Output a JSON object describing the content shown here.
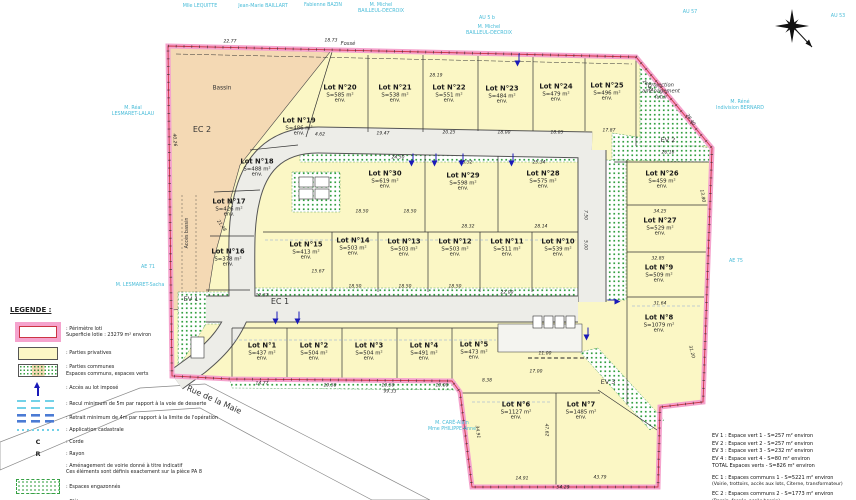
{
  "colors": {
    "perimeter_pink": "#f5a3cd",
    "perimeter_red": "#cc3344",
    "lot_yellow": "#fbf7c5",
    "basin_tan": "#f4d9b4",
    "green": "#35a043",
    "road_gray": "#ededе8",
    "owner_cyan": "#49bcd8",
    "access_blue": "#1a1ab8"
  },
  "legend": {
    "title": "LEGENDE :",
    "items": [
      {
        "icon": "perimeter",
        "label": ": Périmètre loti",
        "label2": "Superficie lotie : 23279 m² environ"
      },
      {
        "icon": "private",
        "label": ": Parties privatives"
      },
      {
        "icon": "common",
        "label": ": Parties communes",
        "label2": "Espaces communs, espaces verts"
      },
      {
        "icon": "arrow",
        "label": ": Accès au lot imposé"
      },
      {
        "icon": "recul",
        "label": ": Recul minimum de 5m par rapport à la voie de desserte"
      },
      {
        "icon": "retrait",
        "label": ": Retrait minimum de 4m par rapport à la limite de l'opération"
      },
      {
        "icon": "cadastre",
        "label": ": Application cadastrale"
      },
      {
        "icon": "C",
        "label": ": Corde"
      },
      {
        "icon": "R",
        "label": ": Rayon"
      },
      {
        "icon": "none",
        "label": ": Aménagement de voirie donné à titre indicatif",
        "label2": "Ces éléments sont définis exactement sur la pièce PA 8"
      },
      {
        "icon": "grass",
        "label": ": Espaces engazonnés"
      },
      {
        "icon": "fence",
        "label": ": Clôture"
      },
      {
        "icon": "hedge",
        "label": ": Haie"
      }
    ]
  },
  "summary": {
    "ev_lines": [
      "EV 1 : Espace vert 1 - S=257 m² environ",
      "EV 2 : Espace vert 2 - S=257 m² environ",
      "EV 3 : Espace vert 3 - S=232 m² environ",
      "EV 4 : Espace vert 4 - S=80 m² environ",
      "TOTAL Espaces verts - S=826 m² environ"
    ],
    "ec_groups": [
      {
        "line1": "EC 1 : Espaces communs 1 - S=5221 m² environ",
        "line2": "(Voirie, trottoirs, accès aux lots, Citerne, transformateur)"
      },
      {
        "line1": "EC 2 : Espaces communs 2 - S=1773 m² environ",
        "line2": "(Bassin, fossés, accès bassin)"
      }
    ]
  },
  "map": {
    "lot_env": "env.",
    "lots": [
      {
        "name": "Lot N°1",
        "area": "S=437 m²",
        "x": 262,
        "y": 352
      },
      {
        "name": "Lot N°2",
        "area": "S=504 m²",
        "x": 314,
        "y": 352
      },
      {
        "name": "Lot N°3",
        "area": "S=504 m²",
        "x": 369,
        "y": 352
      },
      {
        "name": "Lot N°4",
        "area": "S=491 m²",
        "x": 424,
        "y": 352
      },
      {
        "name": "Lot N°5",
        "area": "S=473 m²",
        "x": 474,
        "y": 351
      },
      {
        "name": "Lot N°6",
        "area": "S=1127 m²",
        "x": 516,
        "y": 411
      },
      {
        "name": "Lot N°7",
        "area": "S=1485 m²",
        "x": 581,
        "y": 411
      },
      {
        "name": "Lot N°8",
        "area": "S=1079 m²",
        "x": 659,
        "y": 324
      },
      {
        "name": "Lot N°9",
        "area": "S=509 m²",
        "x": 659,
        "y": 274
      },
      {
        "name": "Lot N°10",
        "area": "S=539 m²",
        "x": 558,
        "y": 248
      },
      {
        "name": "Lot N°11",
        "area": "S=511 m²",
        "x": 507,
        "y": 248
      },
      {
        "name": "Lot N°12",
        "area": "S=503 m²",
        "x": 455,
        "y": 248
      },
      {
        "name": "Lot N°13",
        "area": "S=503 m²",
        "x": 404,
        "y": 248
      },
      {
        "name": "Lot N°14",
        "area": "S=503 m²",
        "x": 353,
        "y": 247
      },
      {
        "name": "Lot N°15",
        "area": "S=413 m²",
        "x": 306,
        "y": 251
      },
      {
        "name": "Lot N°16",
        "area": "S=378 m²",
        "x": 228,
        "y": 258
      },
      {
        "name": "Lot N°17",
        "area": "S=426 m²",
        "x": 229,
        "y": 208
      },
      {
        "name": "Lot N°18",
        "area": "S=488 m²",
        "x": 257,
        "y": 168
      },
      {
        "name": "Lot N°19",
        "area": "S=486 m²",
        "x": 299,
        "y": 127
      },
      {
        "name": "Lot N°20",
        "area": "S=585 m²",
        "x": 340,
        "y": 94
      },
      {
        "name": "Lot N°21",
        "area": "S=538 m²",
        "x": 395,
        "y": 94
      },
      {
        "name": "Lot N°22",
        "area": "S=551 m²",
        "x": 449,
        "y": 94
      },
      {
        "name": "Lot N°23",
        "area": "S=484 m²",
        "x": 502,
        "y": 95
      },
      {
        "name": "Lot N°24",
        "area": "S=479 m²",
        "x": 556,
        "y": 93
      },
      {
        "name": "Lot N°25",
        "area": "S=496 m²",
        "x": 607,
        "y": 92
      },
      {
        "name": "Lot N°26",
        "area": "S=459 m²",
        "x": 662,
        "y": 180
      },
      {
        "name": "Lot N°27",
        "area": "S=529 m²",
        "x": 660,
        "y": 227
      },
      {
        "name": "Lot N°28",
        "area": "S=575 m²",
        "x": 543,
        "y": 180
      },
      {
        "name": "Lot N°29",
        "area": "S=598 m²",
        "x": 463,
        "y": 182
      },
      {
        "name": "Lot N°30",
        "area": "S=619 m²",
        "x": 385,
        "y": 180
      }
    ],
    "labels": [
      {
        "text": "Bassin",
        "x": 222,
        "y": 89,
        "size": 5.8
      },
      {
        "text": "EC 2",
        "x": 202,
        "y": 130,
        "size": 8
      },
      {
        "text": "EV 1",
        "x": 191,
        "y": 300,
        "size": 6.5
      },
      {
        "text": "EC 1",
        "x": 280,
        "y": 302,
        "size": 8
      },
      {
        "text": "EV 2",
        "x": 668,
        "y": 141,
        "size": 6.5
      },
      {
        "text": "EV 3",
        "x": 608,
        "y": 383,
        "size": 6.5
      },
      {
        "text": "Fossé",
        "x": 348,
        "y": 44,
        "size": 5.2,
        "italic": true
      },
      {
        "text": "Accès bassin",
        "x": 188,
        "y": 233,
        "size": 4.8,
        "rot": -90
      },
      {
        "text": "Rue de la Maie",
        "x": 214,
        "y": 400,
        "size": 8,
        "rot": 24
      },
      {
        "text": "Projection\naménagement\nfutur",
        "x": 661,
        "y": 92,
        "size": 5.2,
        "italic": true
      }
    ],
    "owners": [
      {
        "text": "Mlle LEQUITTE",
        "x": 200,
        "y": 7
      },
      {
        "text": "Jean-Marie BAILLART",
        "x": 263,
        "y": 7
      },
      {
        "text": "Fabienne BAZIN",
        "x": 323,
        "y": 6
      },
      {
        "text": "M. Michel\nBAILLEUL-DECROIX",
        "x": 381,
        "y": 9
      },
      {
        "text": "AU 5 b",
        "x": 487,
        "y": 19
      },
      {
        "text": "M. Michel\nBAILLEUL-DECROIX",
        "x": 489,
        "y": 31
      },
      {
        "text": "AU 57",
        "x": 690,
        "y": 13
      },
      {
        "text": "AU 53",
        "x": 838,
        "y": 17
      },
      {
        "text": "M. Réné\nIndivision BERNARD",
        "x": 740,
        "y": 106
      },
      {
        "text": "AE 75",
        "x": 736,
        "y": 262
      },
      {
        "text": "M. Réal\nLESMARET-LALAU",
        "x": 133,
        "y": 112
      },
      {
        "text": "AE 71",
        "x": 148,
        "y": 268
      },
      {
        "text": "M. LESMARET-Sacha",
        "x": 140,
        "y": 286
      },
      {
        "text": "M. CARÉ-Alain\nMme PHILIPPE-Anne",
        "x": 452,
        "y": 427
      }
    ],
    "dimensions": [
      {
        "t": "22.77",
        "x": 230,
        "y": 42
      },
      {
        "t": "18.73",
        "x": 331,
        "y": 41
      },
      {
        "t": "28.19",
        "x": 436,
        "y": 76
      },
      {
        "t": "26.40",
        "x": 647,
        "y": 86,
        "r": 50
      },
      {
        "t": "4.62",
        "x": 320,
        "y": 135
      },
      {
        "t": "19.47",
        "x": 383,
        "y": 134
      },
      {
        "t": "20.25",
        "x": 449,
        "y": 133
      },
      {
        "t": "18.00",
        "x": 504,
        "y": 133
      },
      {
        "t": "18.05",
        "x": 557,
        "y": 133
      },
      {
        "t": "17.87",
        "x": 609,
        "y": 131
      },
      {
        "t": "28.40",
        "x": 690,
        "y": 120,
        "r": 55
      },
      {
        "t": "26.16",
        "x": 668,
        "y": 153
      },
      {
        "t": "13.80",
        "x": 702,
        "y": 196,
        "r": 80
      },
      {
        "t": "34.25",
        "x": 660,
        "y": 212
      },
      {
        "t": "32.85",
        "x": 658,
        "y": 259
      },
      {
        "t": "31.64",
        "x": 660,
        "y": 304
      },
      {
        "t": "31.20",
        "x": 691,
        "y": 352,
        "r": 75
      },
      {
        "t": "40.26",
        "x": 174,
        "y": 140,
        "r": 85
      },
      {
        "t": "24.50",
        "x": 398,
        "y": 158
      },
      {
        "t": "28.52",
        "x": 466,
        "y": 163
      },
      {
        "t": "25.34",
        "x": 539,
        "y": 163
      },
      {
        "t": "28.32",
        "x": 468,
        "y": 227
      },
      {
        "t": "28.14",
        "x": 541,
        "y": 227
      },
      {
        "t": "18.50",
        "x": 362,
        "y": 212
      },
      {
        "t": "18.50",
        "x": 410,
        "y": 212
      },
      {
        "t": "15.67",
        "x": 318,
        "y": 272
      },
      {
        "t": "18.50",
        "x": 355,
        "y": 287
      },
      {
        "t": "18.50",
        "x": 405,
        "y": 287
      },
      {
        "t": "18.50",
        "x": 455,
        "y": 287
      },
      {
        "t": "22.00",
        "x": 507,
        "y": 293
      },
      {
        "t": "21.48",
        "x": 221,
        "y": 226,
        "r": 55
      },
      {
        "t": "12.37",
        "x": 262,
        "y": 296
      },
      {
        "t": "7.50",
        "x": 585,
        "y": 215,
        "r": 90
      },
      {
        "t": "5.00",
        "x": 585,
        "y": 245,
        "r": 90
      },
      {
        "t": "14.77",
        "x": 262,
        "y": 384
      },
      {
        "t": "19.50",
        "x": 330,
        "y": 386
      },
      {
        "t": "19.50",
        "x": 388,
        "y": 386
      },
      {
        "t": "19.00",
        "x": 442,
        "y": 386
      },
      {
        "t": "8.38",
        "x": 487,
        "y": 381
      },
      {
        "t": "99.33",
        "x": 390,
        "y": 392
      },
      {
        "t": "11.00",
        "x": 545,
        "y": 354
      },
      {
        "t": "17.00",
        "x": 536,
        "y": 372
      },
      {
        "t": "34.91",
        "x": 477,
        "y": 432,
        "r": 83
      },
      {
        "t": "47.62",
        "x": 546,
        "y": 430,
        "r": 88
      },
      {
        "t": "14.91",
        "x": 522,
        "y": 479
      },
      {
        "t": "43.79",
        "x": 600,
        "y": 478
      },
      {
        "t": "54.29",
        "x": 563,
        "y": 488
      }
    ],
    "arrows": [
      {
        "x": 519,
        "y": 60,
        "d": "down"
      },
      {
        "x": 413,
        "y": 160,
        "d": "down"
      },
      {
        "x": 436,
        "y": 160,
        "d": "down"
      },
      {
        "x": 463,
        "y": 160,
        "d": "down"
      },
      {
        "x": 513,
        "y": 160,
        "d": "down"
      },
      {
        "x": 277,
        "y": 318,
        "d": "down"
      },
      {
        "x": 299,
        "y": 318,
        "d": "down"
      },
      {
        "x": 588,
        "y": 334,
        "d": "down"
      },
      {
        "x": 614,
        "y": 300,
        "d": "right"
      }
    ]
  }
}
